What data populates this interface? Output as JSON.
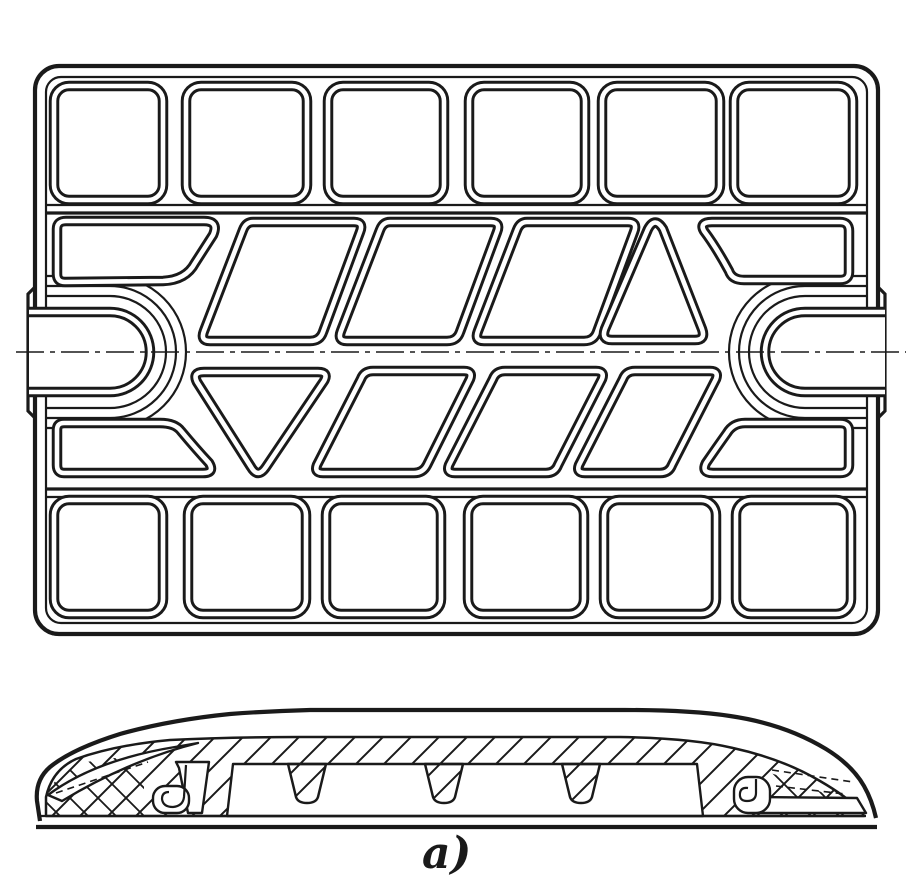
{
  "figure": {
    "label": "a)"
  },
  "colors": {
    "ink": "#1a1a1a",
    "paper": "#ffffff"
  }
}
